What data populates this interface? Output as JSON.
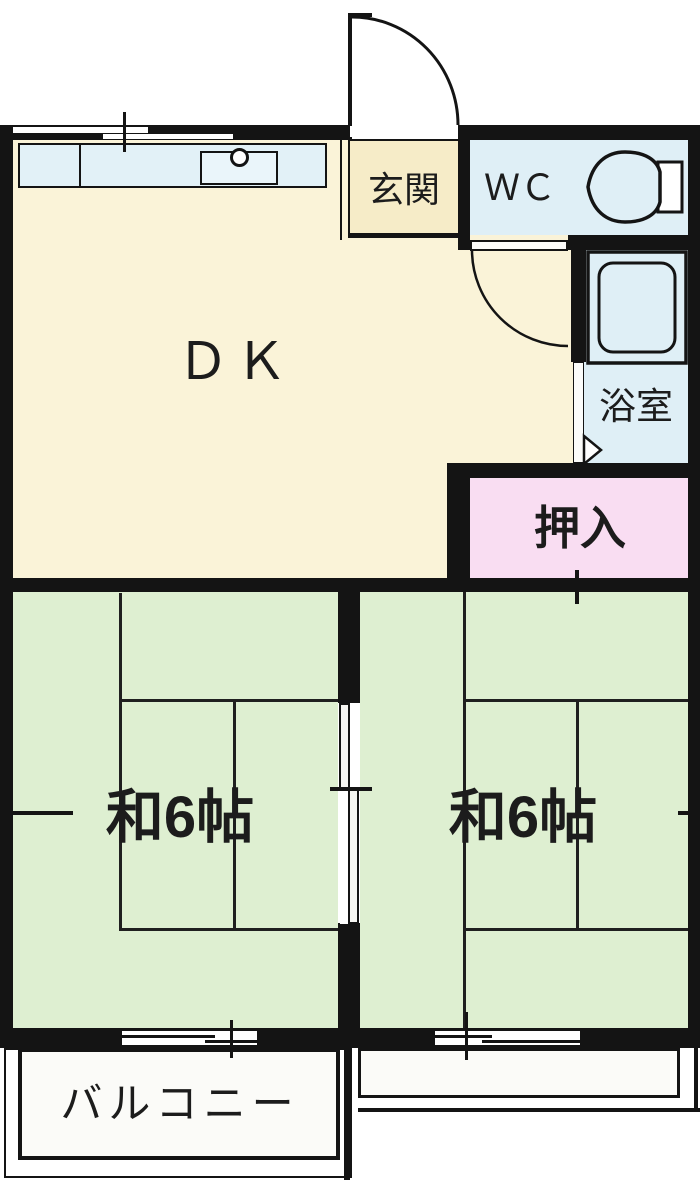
{
  "floorplan": {
    "rooms": {
      "dk": "ＤＫ",
      "genkan": "玄関",
      "wc": "ＷＣ",
      "bathroom": "浴室",
      "closet": "押入",
      "tatami_left": "和6帖",
      "tatami_right": "和6帖",
      "balcony": "バルコニー"
    },
    "colors": {
      "wall": "#141414",
      "dk_floor": "#faf3d8",
      "genkan_floor": "#f6ecc8",
      "wet_area_blue": "#dfeff6",
      "closet_pink": "#f9ddf2",
      "tatami_green": "#deefd1",
      "balcony_white": "#fbfbf8",
      "counter_blue": "#e2f1f7"
    },
    "icons": {
      "toilet": "toilet-icon",
      "bathtub": "bathtub-icon",
      "kitchen_sink": "kitchen-sink-icon",
      "faucet": "faucet-icon",
      "entry_door": "entry-door-arc-icon",
      "dk_door": "dk-door-arc-icon",
      "bath_door": "bath-door-arrow-icon",
      "sliding_door": "sliding-door-panels"
    }
  }
}
